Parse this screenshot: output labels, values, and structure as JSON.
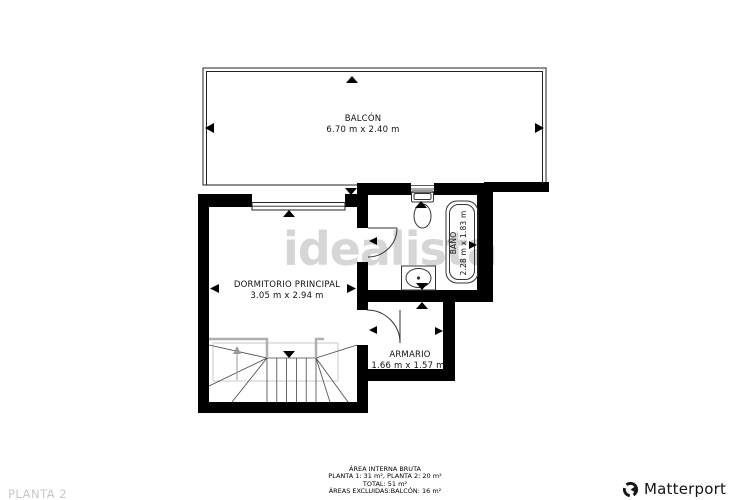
{
  "watermark": {
    "text": "idealista"
  },
  "floor_label": "PLANTA 2",
  "brand": {
    "name": "Matterport"
  },
  "rooms": {
    "balcon": {
      "name": "BALCÓN",
      "dims": "6.70 m x 2.40 m"
    },
    "dormitorio": {
      "name": "DORMITORIO PRINCIPAL",
      "dims": "3.05 m x 2.94 m"
    },
    "bano": {
      "name": "BAÑO",
      "dims": "2.28 m x 1.83 m"
    },
    "armario": {
      "name": "ARMARIO",
      "dims": "1.66 m x 1.57 m"
    }
  },
  "summary": {
    "title": "ÁREA INTERNA BRUTA",
    "plantas": "PLANTA 1: 31 m², PLANTA 2: 20 m²",
    "total": "TOTAL: 51 m²",
    "excluded": "ÁREAS EXCLUIDAS:BALCÓN: 16 m²"
  },
  "colors": {
    "wall": "#000000",
    "thin_line": "#222222",
    "fixture_line": "#333333",
    "watermark": "#d6d6d6",
    "floor_label": "#c8c8c8",
    "stair_rail": "#b0b0b0"
  }
}
